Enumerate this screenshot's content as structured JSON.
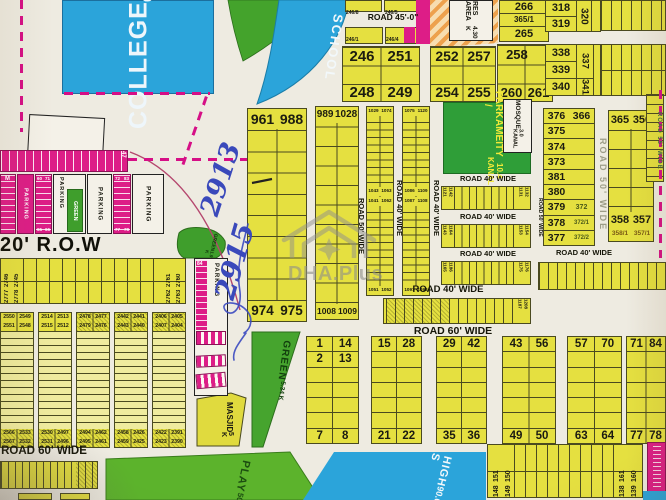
{
  "colors": {
    "plot_yellow": "#e5e040",
    "magenta": "#dd1d87",
    "green": "#44a32c",
    "blue": "#2ba4da",
    "paper": "#eeebe1",
    "ink_blue": "#3a49bb",
    "hatch_orange": "#eda14d"
  },
  "landmarks": {
    "college": {
      "name": "COLLEGE",
      "size": "63.67 K"
    },
    "school": "SCHOOL",
    "res_area": {
      "name": "RES AREA",
      "size": "4.30 K"
    },
    "park": {
      "l1": "PARK /",
      "l2": "AMEITY",
      "l3": "10.4 KANAL"
    },
    "mosque": {
      "name": "MOSQUE",
      "size": "3.0 KANAL"
    },
    "masjid": {
      "name": "MASJID",
      "size": "5 K"
    },
    "green_tri": {
      "name": "GREEN",
      "size": "5.34 K"
    },
    "green_blob": {
      "name": "GREEN",
      "size": "1.9 K"
    },
    "play": {
      "name": "PLAY",
      "size": "50"
    },
    "high_school": {
      "name": "HIGH S",
      "size": "90.6"
    },
    "row20": "20' R.O.W"
  },
  "roads": {
    "r45": "ROAD 45'-0\"",
    "r40": "ROAD 40' WIDE",
    "r50": "ROAD 50' WIDE",
    "r55": "ROAD 55' WIDE",
    "r60": "ROAD 60' WIDE"
  },
  "handwriting": {
    "a": "2913",
    "b": "2915"
  },
  "watermark": "DHA.Plus",
  "parking": {
    "label": "PARKING",
    "m": "M",
    "n47": "47",
    "n84": "84",
    "green": "GREEN",
    "ln": [
      "60",
      "71",
      "65",
      "66"
    ],
    "rn": [
      "72",
      "83",
      "77",
      "78"
    ]
  },
  "top": {
    "above45": [
      "246/8",
      "246/5"
    ],
    "below45": [
      "246/1",
      "246/4"
    ],
    "b246": {
      "h": [
        "246",
        "251"
      ],
      "f": [
        "248",
        "249"
      ]
    },
    "b252": {
      "h": [
        "252",
        "257"
      ],
      "f": [
        "254",
        "255"
      ]
    },
    "b258": {
      "h": [
        "258",
        ""
      ],
      "f": [
        "260",
        "261"
      ]
    },
    "col265": [
      "266",
      "365/1",
      "265"
    ],
    "b318": {
      "r1": "318",
      "r2": "319",
      "rot": "320"
    },
    "b338": {
      "r1": "338",
      "r2": "339",
      "r3": "340",
      "rot1": "337",
      "rot2": "341"
    }
  },
  "center": {
    "blockA": {
      "h": [
        "961",
        "988"
      ],
      "f": [
        "974",
        "975"
      ]
    },
    "blockB": {
      "h": [
        "989",
        "1028"
      ],
      "f": [
        "1008",
        "1009"
      ]
    },
    "c1": {
      "t": [
        "1029",
        "1074"
      ],
      "m1": [
        "1043",
        "1063"
      ],
      "m2": [
        "1041",
        "1062"
      ],
      "b": [
        "1051",
        "1052"
      ]
    },
    "c2": {
      "t": [
        "1075",
        "1120"
      ],
      "m1": [
        "1086",
        "1109"
      ],
      "m2": [
        "1087",
        "1108"
      ],
      "b": [
        "1097",
        "1098"
      ]
    },
    "s1": {
      "l": [
        "1121",
        "1142"
      ],
      "r": [
        "1131",
        "1132"
      ]
    },
    "s2": {
      "l": [
        "1143",
        "1164"
      ],
      "r": [
        "1153",
        "1154"
      ]
    },
    "s3": {
      "l": [
        "1165",
        "1186"
      ],
      "r": [
        "1175",
        "1176"
      ]
    },
    "ws": {
      "r": [
        "1187",
        "1208"
      ]
    }
  },
  "right": {
    "colD": {
      "rows": [
        [
          "376",
          "366"
        ],
        [
          "375",
          ""
        ],
        [
          "374",
          ""
        ],
        [
          "373",
          ""
        ],
        [
          "381",
          ""
        ],
        [
          "380",
          ""
        ],
        [
          "379",
          "372"
        ],
        [
          "378",
          "372/1"
        ],
        [
          "377",
          "372/2"
        ]
      ]
    },
    "colE": {
      "h": [
        "365",
        "350"
      ],
      "f": [
        "358",
        "357"
      ],
      "f2": [
        "358/1",
        "357/1"
      ]
    }
  },
  "bl": {
    "strip": {
      "l1": [
        "2777",
        "2746"
      ],
      "l2": [
        "2778",
        "2745"
      ],
      "r1": [
        "2762",
        "2761"
      ],
      "r2": [
        "2763",
        "2760"
      ]
    },
    "cols": [
      {
        "h1": [
          "2550",
          "2549"
        ],
        "h2": [
          "2551",
          "2548"
        ],
        "f1": [
          "2566",
          "2533"
        ],
        "f2": [
          "2567",
          "2532"
        ]
      },
      {
        "h1": [
          "2514",
          "2513"
        ],
        "h2": [
          "2515",
          "2512"
        ],
        "f1": [
          "2530",
          "2497"
        ],
        "f2": [
          "2531",
          "2496"
        ]
      },
      {
        "h1": [
          "2478",
          "2477"
        ],
        "h2": [
          "2479",
          "2476"
        ],
        "f1": [
          "2494",
          "2462"
        ],
        "f2": [
          "2495",
          "2461"
        ]
      },
      {
        "h1": [
          "2442",
          "2441"
        ],
        "h2": [
          "2443",
          "2440"
        ],
        "f1": [
          "2458",
          "2426"
        ],
        "f2": [
          "2459",
          "2425"
        ]
      },
      {
        "h1": [
          "2406",
          "2405"
        ],
        "h2": [
          "2407",
          "2404"
        ],
        "f1": [
          "2422",
          "2391"
        ],
        "f2": [
          "2423",
          "2390"
        ]
      }
    ]
  },
  "bot": {
    "cols": [
      {
        "h": [
          "1",
          "14"
        ],
        "h2": [
          "2",
          "13"
        ],
        "f": [
          "7",
          "8"
        ]
      },
      {
        "h": [
          "15",
          "28"
        ],
        "h2": [
          "",
          ""
        ],
        "f": [
          "21",
          "22"
        ]
      },
      {
        "h": [
          "29",
          "42"
        ],
        "h2": [
          "",
          ""
        ],
        "f": [
          "35",
          "36"
        ]
      },
      {
        "h": [
          "43",
          "56"
        ],
        "h2": [
          "",
          ""
        ],
        "f": [
          "49",
          "50"
        ]
      },
      {
        "h": [
          "57",
          "70"
        ],
        "h2": [
          "",
          ""
        ],
        "f": [
          "63",
          "64"
        ]
      },
      {
        "h": [
          "71",
          "84"
        ],
        "h2": [
          "",
          ""
        ],
        "f": [
          "77",
          "78"
        ]
      }
    ],
    "s148": {
      "l1": [
        "148",
        "151"
      ],
      "l2": [
        "149",
        "150"
      ],
      "r1": [
        "138",
        "161"
      ],
      "r2": [
        "139",
        "160"
      ]
    }
  }
}
